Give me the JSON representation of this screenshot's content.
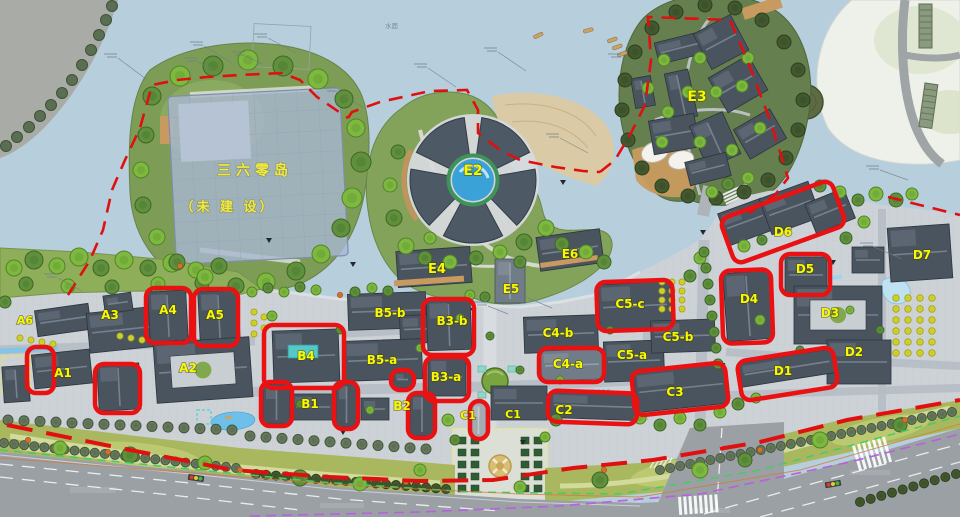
{
  "page": {
    "type": "architectural master plan",
    "canvas": {
      "width": 960,
      "height": 517
    }
  },
  "map": {
    "island_note": {
      "line1": "三六零岛",
      "line2": "（未 建 设）"
    },
    "water_label": "水面",
    "colors": {
      "water": "#b7cedd",
      "highlight_red": "#ea1113",
      "boundary_red": "#e01010",
      "label_yellow": "#f8f800",
      "island_note_yellow": "#f2ea3c",
      "park_green": "#a9b85e",
      "campus_paving": "#cdd2d7",
      "building_dark": "#49545f"
    },
    "zones": [
      {
        "label": "A6",
        "x": 25,
        "y": 324,
        "fs": 11
      },
      {
        "label": "A3",
        "x": 110,
        "y": 319,
        "fs": 12
      },
      {
        "label": "A4",
        "x": 168,
        "y": 314,
        "fs": 12
      },
      {
        "label": "A5",
        "x": 215,
        "y": 319,
        "fs": 12
      },
      {
        "label": "A1",
        "x": 63,
        "y": 377,
        "fs": 12
      },
      {
        "label": "A2",
        "x": 188,
        "y": 372,
        "fs": 12
      },
      {
        "label": "B5-b",
        "x": 390,
        "y": 317,
        "fs": 12
      },
      {
        "label": "B3-b",
        "x": 452,
        "y": 325,
        "fs": 12
      },
      {
        "label": "B4",
        "x": 306,
        "y": 360,
        "fs": 12
      },
      {
        "label": "B5-a",
        "x": 382,
        "y": 364,
        "fs": 12
      },
      {
        "label": "B3-a",
        "x": 446,
        "y": 381,
        "fs": 12
      },
      {
        "label": "B1",
        "x": 310,
        "y": 408,
        "fs": 12
      },
      {
        "label": "B2",
        "x": 402,
        "y": 410,
        "fs": 12
      },
      {
        "label": "C1",
        "x": 468,
        "y": 419,
        "fs": 11
      },
      {
        "label": "C1",
        "x": 513,
        "y": 418,
        "fs": 11
      },
      {
        "label": "C4-b",
        "x": 558,
        "y": 337,
        "fs": 12
      },
      {
        "label": "C5-c",
        "x": 630,
        "y": 308,
        "fs": 12
      },
      {
        "label": "C5-b",
        "x": 678,
        "y": 341,
        "fs": 12
      },
      {
        "label": "C5-a",
        "x": 632,
        "y": 359,
        "fs": 12
      },
      {
        "label": "C4-a",
        "x": 568,
        "y": 368,
        "fs": 12
      },
      {
        "label": "C2",
        "x": 564,
        "y": 414,
        "fs": 12
      },
      {
        "label": "C3",
        "x": 675,
        "y": 396,
        "fs": 12
      },
      {
        "label": "D6",
        "x": 783,
        "y": 236,
        "fs": 12
      },
      {
        "label": "D5",
        "x": 805,
        "y": 273,
        "fs": 12
      },
      {
        "label": "D4",
        "x": 749,
        "y": 303,
        "fs": 12
      },
      {
        "label": "D3",
        "x": 830,
        "y": 317,
        "fs": 12
      },
      {
        "label": "D2",
        "x": 854,
        "y": 356,
        "fs": 12
      },
      {
        "label": "D1",
        "x": 783,
        "y": 375,
        "fs": 12
      },
      {
        "label": "D7",
        "x": 922,
        "y": 259,
        "fs": 12
      },
      {
        "label": "E2",
        "x": 473,
        "y": 175,
        "fs": 14
      },
      {
        "label": "E3",
        "x": 697,
        "y": 101,
        "fs": 14
      },
      {
        "label": "E4",
        "x": 437,
        "y": 273,
        "fs": 13
      },
      {
        "label": "E5",
        "x": 511,
        "y": 293,
        "fs": 12
      },
      {
        "label": "E6",
        "x": 570,
        "y": 258,
        "fs": 12
      }
    ],
    "highlights": [
      {
        "x": 27,
        "y": 347,
        "w": 27,
        "h": 46,
        "rot": 0
      },
      {
        "x": 95,
        "y": 364,
        "w": 45,
        "h": 49,
        "rot": 0
      },
      {
        "x": 146,
        "y": 288,
        "w": 45,
        "h": 55,
        "rot": 0
      },
      {
        "x": 194,
        "y": 289,
        "w": 44,
        "h": 57,
        "rot": 0
      },
      {
        "x": 264,
        "y": 325,
        "w": 80,
        "h": 63,
        "rot": 0
      },
      {
        "x": 261,
        "y": 382,
        "w": 31,
        "h": 44,
        "rot": 0
      },
      {
        "x": 334,
        "y": 382,
        "w": 24,
        "h": 47,
        "rot": 0
      },
      {
        "x": 391,
        "y": 370,
        "w": 23,
        "h": 20,
        "rot": 0
      },
      {
        "x": 423,
        "y": 299,
        "w": 51,
        "h": 56,
        "rot": 0
      },
      {
        "x": 425,
        "y": 357,
        "w": 44,
        "h": 44,
        "rot": 0
      },
      {
        "x": 408,
        "y": 393,
        "w": 27,
        "h": 45,
        "rot": 0
      },
      {
        "x": 470,
        "y": 401,
        "w": 18,
        "h": 38,
        "rot": 0
      },
      {
        "x": 597,
        "y": 281,
        "w": 76,
        "h": 49,
        "rot": -2
      },
      {
        "x": 539,
        "y": 348,
        "w": 65,
        "h": 34,
        "rot": 0
      },
      {
        "x": 548,
        "y": 392,
        "w": 89,
        "h": 31,
        "rot": 2
      },
      {
        "x": 633,
        "y": 367,
        "w": 94,
        "h": 44,
        "rot": -6
      },
      {
        "x": 722,
        "y": 270,
        "w": 50,
        "h": 73,
        "rot": -2
      },
      {
        "x": 781,
        "y": 254,
        "w": 49,
        "h": 41,
        "rot": 0
      },
      {
        "x": 724,
        "y": 198,
        "w": 118,
        "h": 48,
        "rot": -20
      },
      {
        "x": 739,
        "y": 354,
        "w": 97,
        "h": 40,
        "rot": -9
      }
    ]
  }
}
